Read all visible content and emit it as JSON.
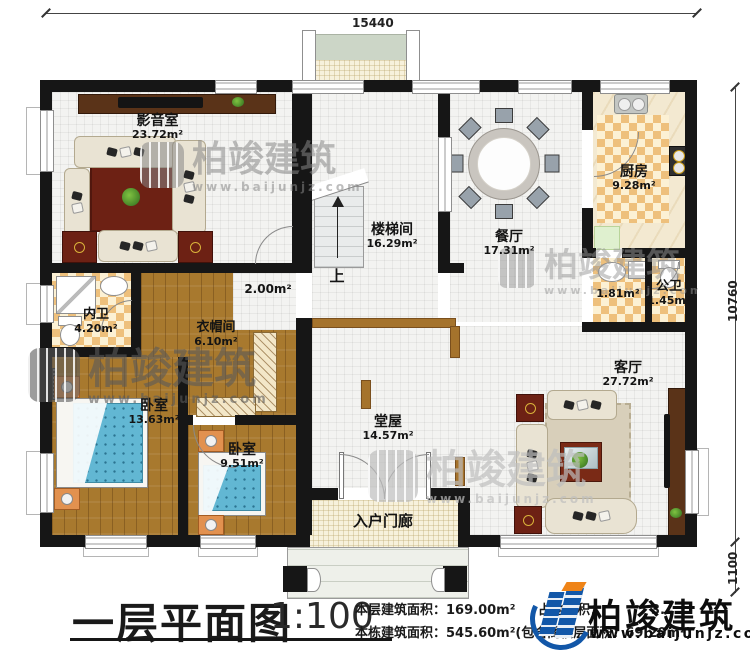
{
  "dims": {
    "top": "15440",
    "right_main": "10760",
    "right_lower": "1100"
  },
  "rooms": {
    "media": {
      "name": "影音室",
      "area": "23.72m²"
    },
    "stairwell": {
      "name": "楼梯间",
      "area": "16.29m²"
    },
    "dining": {
      "name": "餐厅",
      "area": "17.31m²"
    },
    "kitchen": {
      "name": "厨房",
      "area": "9.28m²"
    },
    "washroom": {
      "area": "1.81m²"
    },
    "public_wc": {
      "name": "公卫",
      "area": "1.45m²"
    },
    "private_wc": {
      "name": "内卫",
      "area": "4.20m²"
    },
    "cloakroom": {
      "name": "衣帽间",
      "area": "6.10m²"
    },
    "bedroom_large": {
      "name": "卧室",
      "area": "13.63m²"
    },
    "bedroom_small": {
      "name": "卧室",
      "area": "9.51m²"
    },
    "hall": {
      "name": "堂屋",
      "area": "14.57m²"
    },
    "living": {
      "name": "客厅",
      "area": "27.72m²"
    },
    "corridor": {
      "area": "2.00m²"
    },
    "porch": {
      "name": "入户门廊"
    },
    "stairs_up": "上"
  },
  "titleblock": {
    "title": "一层平面图",
    "scale": "1:100",
    "floor_area_label": "本层建筑面积：",
    "floor_area_value": "169.00m²",
    "land_area_label": "占地面积：",
    "land_area_value_visible": "3.",
    "total_area_label": "本栋建筑面积：",
    "total_area_value": "545.60m²(包含阁楼层面积：69.20m²)"
  },
  "brand": {
    "name": "柏竣建筑",
    "site": "www.baijunjz.com"
  },
  "watermark": {
    "name": "柏竣建筑",
    "site": "www.baijunjz.com"
  },
  "colors": {
    "wall": "#161616",
    "wood": "#a8792e",
    "checker": "#eec07c",
    "brand_blue": "#1257a8",
    "brand_orange": "#ef8418",
    "bed_blue": "#62b7d3",
    "rug_red": "#6d2114"
  }
}
